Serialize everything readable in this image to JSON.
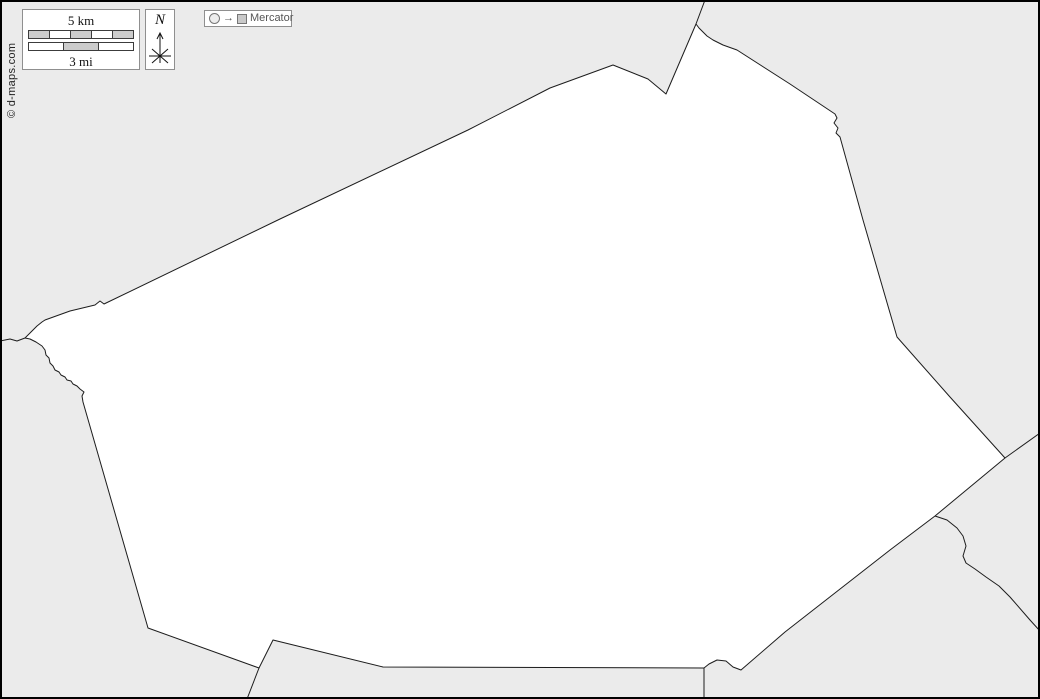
{
  "copyright": "© d-maps.com",
  "scale": {
    "km_label": "5 km",
    "mi_label": "3 mi",
    "km_segments": [
      "gray",
      "white",
      "gray",
      "white",
      "gray"
    ],
    "mi_segments": [
      "white",
      "gray",
      "white"
    ]
  },
  "compass": {
    "north_label": "N"
  },
  "projection": {
    "label": "Mercator",
    "arrow_glyph": "→"
  },
  "colors": {
    "background": "#ebebeb",
    "region_fill": "#ffffff",
    "boundary_line": "#1c1c1c",
    "frame": "#000000",
    "control_border": "#8f8f8f",
    "scale_segment_gray": "#cccccc",
    "projection_text": "#555555"
  },
  "map": {
    "region_outline_points": "613,65 648,79 666,94 696,24 699,28 703,32 707,36 713,40 723,45 737,50 790,84 835,114 837,118 834,123 838,128 836,133 840,137 863,220 897,337 950,397 1005,458 935,516 890,550 785,632 741,670 733,667 726,661 717,660 709,664 704,668 383,667 273,640 259,668 148,628 83,402 82,396 84,392 80,389 77,386 73,384 71,381 67,380 65,377 61,375 59,372 55,370 53,366 50,363 49,358 46,355 45,350 42,346 36,342 30,339 25,338 29,334 33,330 37,326 42,322 45,320 70,311 95,305 100,301 104,304 280,219 468,130 550,88 613,65",
    "boundary_lines": [
      "0,341 10,339 17,341 25,338",
      "705,0 696,24",
      "1005,458 1040,433",
      "935,516 947,520 957,528 963,536 966,546 963,556 966,563 975,569 986,577 999,586 1010,597 1030,620 1040,631",
      "704,668 704,699",
      "259,668 247,699"
    ]
  }
}
